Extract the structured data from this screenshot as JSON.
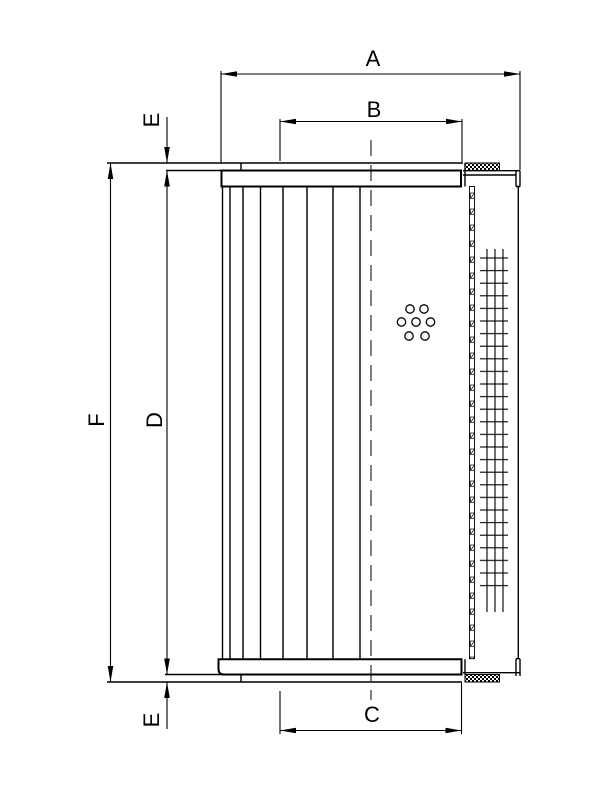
{
  "page": {
    "background_color": "#ffffff",
    "line_color": "#000000"
  },
  "drawing": {
    "dimension_labels": {
      "a": "A",
      "b": "B",
      "c": "C",
      "d": "D",
      "e_top": "E",
      "e_bottom": "E",
      "f": "F"
    }
  }
}
